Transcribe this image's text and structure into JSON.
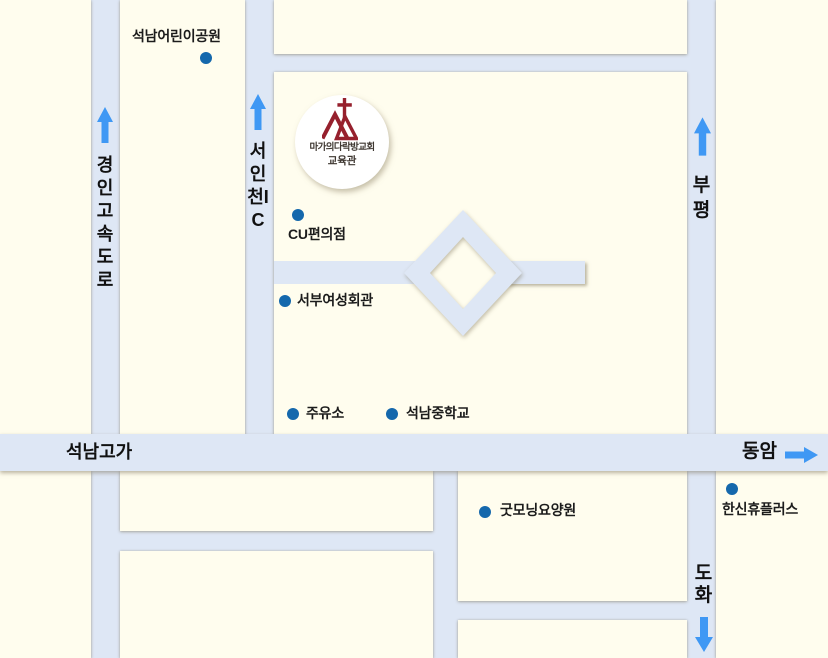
{
  "colors": {
    "cream": "#fffdee",
    "road": "#dee7f5",
    "arrow": "#3f98f4",
    "dot": "#1568ac",
    "ink": "#1c1c1c",
    "church_red": "#96202d",
    "church_text": "#3e3731"
  },
  "road_labels": {
    "gyeongin_expressway": "경인고속도로",
    "seo_incheon_ic": "서인천IC",
    "bupyeong": "부평",
    "dohwa": "도화",
    "seoknam_overpass": "석남고가",
    "dongam": "동암"
  },
  "church": {
    "name": "마가의다락방교회",
    "annex": "교육관"
  },
  "pois": [
    {
      "label": "석남어린이공원"
    },
    {
      "label": "CU편의점"
    },
    {
      "label": "서부여성회관"
    },
    {
      "label": "주유소"
    },
    {
      "label": "석남중학교"
    },
    {
      "label": "굿모닝요양원"
    },
    {
      "label": "한신휴플러스"
    }
  ],
  "icons": {
    "up_arrow": "up-arrow",
    "down_arrow": "down-arrow",
    "right_arrow": "right-arrow",
    "poi_dot": "map-dot",
    "church_emblem": "cross-mountain-emblem"
  }
}
